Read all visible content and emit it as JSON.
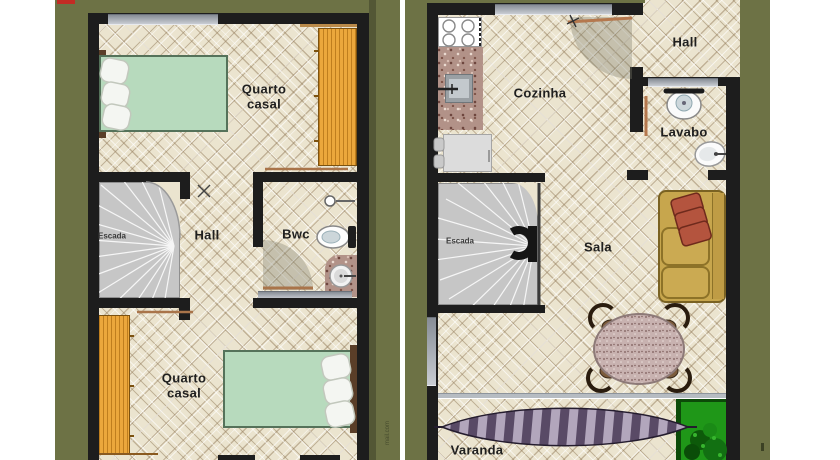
{
  "document_type": "house floor plans, two storeys side by side",
  "labels": {
    "left_bedroom_top": "Quarto\ncasal",
    "left_bedroom_bottom": "Quarto\ncasal",
    "left_hall": "Hall",
    "left_bathroom": "Bwc",
    "left_stairs": "Escada",
    "right_kitchen": "Cozinha",
    "right_hall": "Hall",
    "right_toilet": "Lavabo",
    "right_stairs": "Escada",
    "right_living": "Sala",
    "right_porch": "Varanda"
  },
  "watermark": "mail.com",
  "colors": {
    "page_background": "#ffffff",
    "panel_olive": "#6d7245",
    "wall_black": "#1d1d1d",
    "tile_cream": "#ebe4cf",
    "window_gray": "#9aa0a8",
    "stairs_gray": "#c6c6c6",
    "wardrobe_orange": "#eba73c",
    "mattress_green": "#b7dabd",
    "granite_brown": "#b29288",
    "sofa_tan": "#c7a64d",
    "pillow_red": "#b4543e",
    "hammock_purple_dark": "#594a66",
    "hammock_purple_light": "#b2a6bc",
    "plant_green": "#1f9718",
    "red_mark": "#c32b24"
  }
}
